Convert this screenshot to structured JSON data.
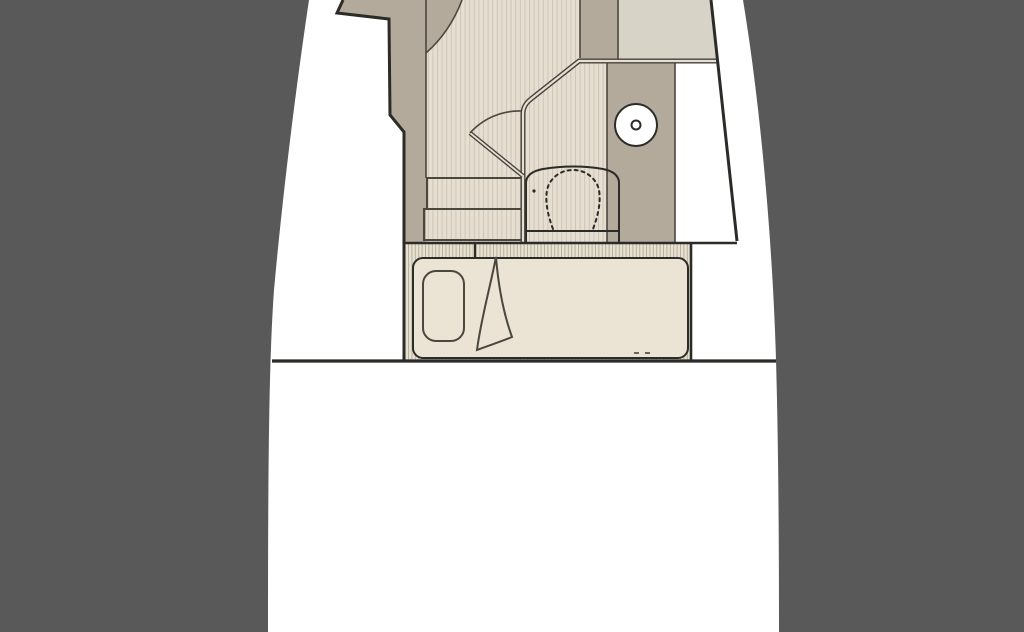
{
  "canvas": {
    "width": 1024,
    "height": 632
  },
  "scene": {
    "kind": "boat-deck-plan-section",
    "area": "forward-cabin",
    "items": [
      {
        "name": "hull-outline"
      },
      {
        "name": "forward-cabin-floor"
      },
      {
        "name": "companionway-steps"
      },
      {
        "name": "cabin-door"
      },
      {
        "name": "head-compartment"
      },
      {
        "name": "toilet"
      },
      {
        "name": "sink-basin"
      },
      {
        "name": "side-cabinet"
      },
      {
        "name": "forward-berth-bed"
      },
      {
        "name": "pillow"
      },
      {
        "name": "blanket-fold"
      },
      {
        "name": "aft-bulkhead"
      }
    ]
  },
  "palette": {
    "bg": "#595959",
    "hull": "#ffffff",
    "tan": "#b3aa9c",
    "floor": "#e6dfd1",
    "floor-stripe": "#cdc5b4",
    "quad": "#d8d3c7",
    "mattress": "#ebe4d4",
    "band": "#e8e1d1",
    "band-stripe": "#b8b09e",
    "line": "#2b2b28",
    "wall": "#45423d",
    "soft": "#4a473f"
  }
}
